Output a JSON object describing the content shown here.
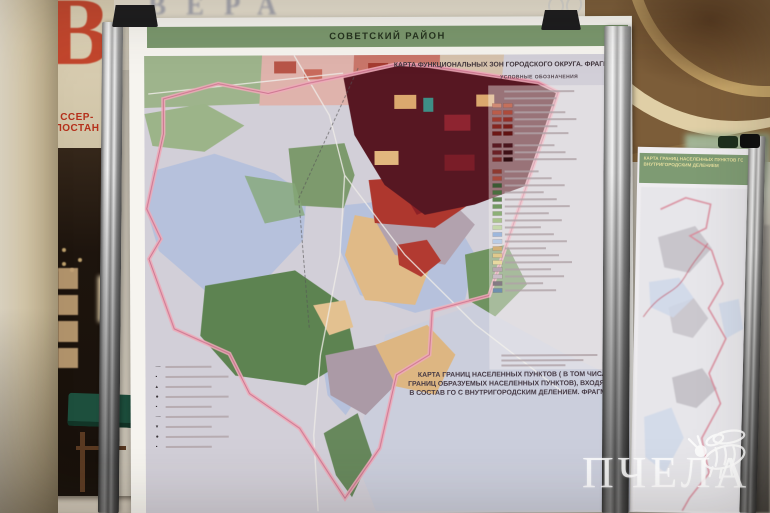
{
  "hall": {
    "inscription": "ВЕРА",
    "poster_letter": "В",
    "poster_text": "ССЕР-ПОСТАН"
  },
  "main_board": {
    "header": "СОВЕТСКИЙ РАЙОН",
    "map_title": "КАРТА ФУНКЦИОНАЛЬНЫХ ЗОН ГОРОДСКОГО ОКРУГА. ФРАГМЕНТ",
    "legend_title": "УСЛОВНЫЕ ОБОЗНАЧЕНИЯ",
    "caption_lines": [
      "КАРТА ГРАНИЦ НАСЕЛЕННЫХ ПУНКТОВ ( В ТОМ ЧИСЛЕ",
      "ГРАНИЦ ОБРАЗУЕМЫХ НАСЕЛЕННЫХ ПУНКТОВ), ВХОДЯЩИХ",
      "В СОСТАВ ГО С ВНУТРИГОРОДСКИМ ДЕЛЕНИЕМ. ФРАГМЕНТ"
    ],
    "legend": {
      "header_rows": 2,
      "red_grid": [
        [
          "#d08a74",
          "#c4705c"
        ],
        [
          "#bb5c4a",
          "#ad4a3b"
        ],
        [
          "#a03a2f",
          "#932e27"
        ],
        [
          "#86251f",
          "#791d19"
        ],
        [
          "#6d1715",
          "#601111"
        ]
      ],
      "dark_grid": [
        [
          "#5a1a22",
          "#4a141c"
        ],
        [
          "#6b2026",
          "#3f1016"
        ],
        [
          "#7c2a2a",
          "#2f0c10"
        ]
      ],
      "entries": [
        "#8e3a30",
        "#a84a3c",
        "#3a5a33",
        "#4a6e3e",
        "#5d8550",
        "#729a61",
        "#8db077",
        "#aac48e",
        "#c5d8ab",
        "#9db7dc",
        "#b9cce6",
        "#d3b078",
        "#e0c98c",
        "#e8d9a0",
        "#b8a7b2",
        "#c9bcc6",
        "#847a84",
        "#6f8fae"
      ]
    },
    "mini_legend": {
      "symbols": [
        "—",
        "▪",
        "▴",
        "●",
        "▪",
        "—",
        "▾",
        "●",
        "▪"
      ]
    }
  },
  "right_board": {
    "header_line1": "КАРТА ГРАНИЦ НАСЕЛЕННЫХ ПУНКТОВ ГО С",
    "header_line2": "ВНУТРИГОРОДСКИМ ДЕЛЕНИЕМ"
  },
  "watermark": {
    "text": "ПЧЕЛА",
    "icon": "bee-icon"
  },
  "palette": {
    "header_green": "#7a976d",
    "boundary_pink": "#edaab8",
    "water_blue": "#b6c1dc",
    "forest_green": "#5d8351",
    "urban_maroon": "#571722",
    "residential_tan": "#e0ba87",
    "industrial_red": "#ae372e",
    "paper": "#f6f4ef",
    "ceiling_gold": "#7c5d39",
    "accent_red": "#c23b22"
  }
}
